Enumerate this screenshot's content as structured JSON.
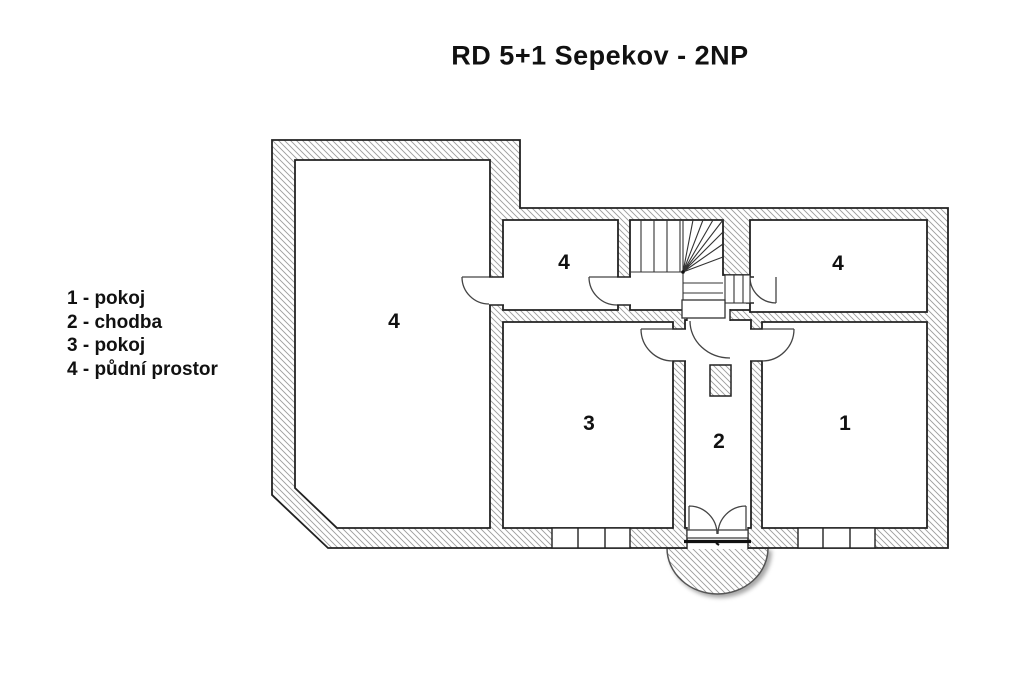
{
  "title": "RD 5+1 Sepekov - 2NP",
  "legend": {
    "items": [
      {
        "number": "1",
        "name": "pokoj",
        "text": "1 - pokoj"
      },
      {
        "number": "2",
        "name": "chodba",
        "text": "2 - chodba"
      },
      {
        "number": "3",
        "name": "pokoj",
        "text": "3 - pokoj"
      },
      {
        "number": "4",
        "name": "půdní prostor",
        "text": "4 - půdní prostor"
      }
    ]
  },
  "floor_plan": {
    "room_labels": [
      {
        "number": "4",
        "room": "půdní prostor",
        "location": "large left room"
      },
      {
        "number": "4",
        "room": "půdní prostor",
        "location": "small middle room"
      },
      {
        "number": "4",
        "room": "půdní prostor",
        "location": "top right room"
      },
      {
        "number": "3",
        "room": "pokoj",
        "location": "lower middle room"
      },
      {
        "number": "2",
        "room": "chodba",
        "location": "central corridor"
      },
      {
        "number": "1",
        "room": "pokoj",
        "location": "lower right room"
      }
    ],
    "features": [
      "staircase-with-winders",
      "chimney",
      "double-entrance-door",
      "semicircular-porch",
      "two-windows-south-wall"
    ]
  },
  "colors": {
    "background": "#ffffff",
    "line": "#1a1a1a",
    "hatch": "#9c9c9c"
  }
}
